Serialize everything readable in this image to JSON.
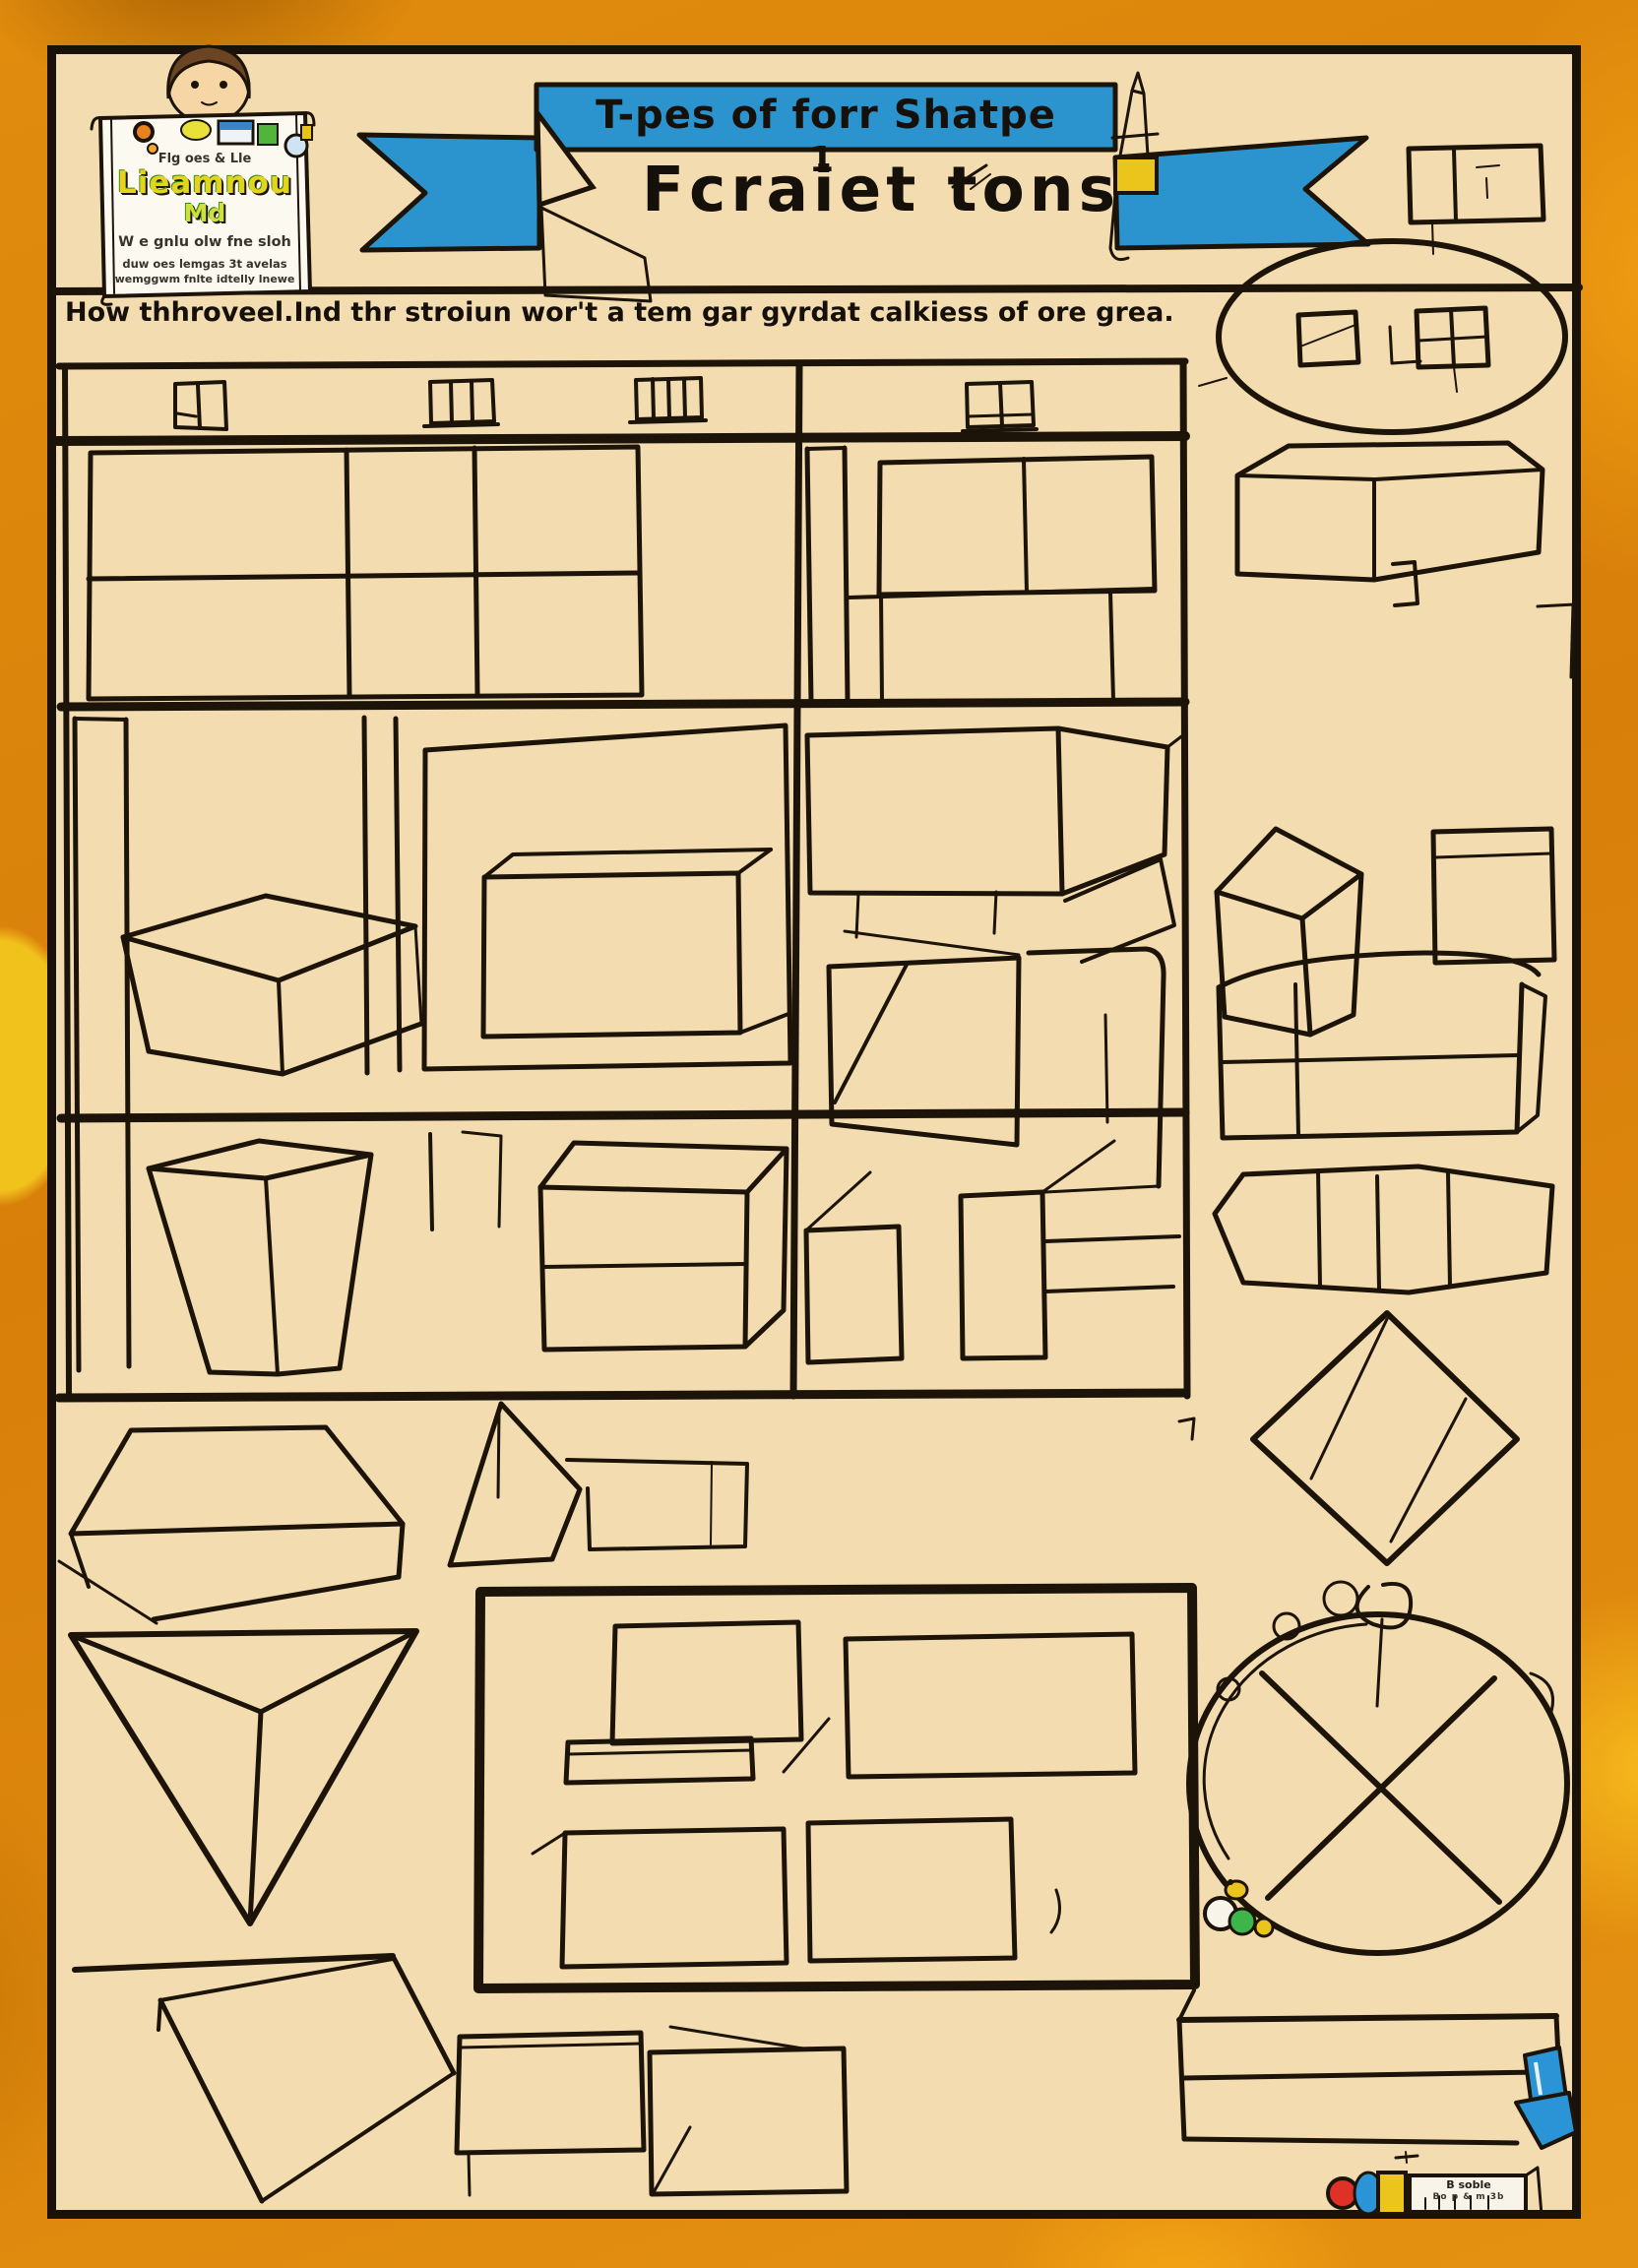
{
  "colors": {
    "border_orange": "#dd860e",
    "page_tan": "#f3ddb0",
    "banner_blue": "#2b94cf",
    "ink": "#1c1309",
    "accent_yellow": "#ecc51c",
    "accent_green": "#3cb54a",
    "accent_red": "#e03127",
    "accent_blue": "#2b94d6"
  },
  "header": {
    "banner_title": "T-pes of forr Shatpe",
    "main_title": "Fcraiet tons",
    "main_title_sup": "1",
    "instruction": "How thhroveel.Ind thr stroiun wor't a tem gar gyrdat calkiess of ore grea."
  },
  "logo": {
    "tagline": "Flg oes & Lle",
    "word_main": "Lieamnou",
    "word_sub": "Md",
    "line1": "W e gnlu olw fne sloh",
    "line2": "duw oes lemgas 3t avelas",
    "line3": "wemggwm fnlte idtelly lnewe"
  },
  "marker_label": {
    "line1": "B soble",
    "line2": "Bo p & m 3b"
  },
  "figures": {
    "table_header_icons": [
      "door-window",
      "three-pane-window",
      "four-pane-window",
      "two-pane-window"
    ],
    "sketches": [
      "partitioned-grid-box",
      "thin-panel",
      "divided-box-with-shelf",
      "open-box-lid",
      "tall-side-panel",
      "panel-with-inset-3d-box",
      "long-3d-table-box",
      "open-box",
      "rounded-panel",
      "bucket-box",
      "cube-dresser",
      "corner-marks",
      "small-panel",
      "stepped-panel",
      "house-prism",
      "triangular-pyramid-with-arm",
      "inverted-triangular-prism",
      "framed-panel-with-four-rectangles",
      "corner-table",
      "square-left",
      "square-right",
      "oval-with-two-squares",
      "wide-prism",
      "cube",
      "plain-square",
      "dresser-3d-box",
      "hexagonal-prism",
      "diamond-kite",
      "wreath-circle-with-cross",
      "beads",
      "long-shelf-with-blue-pencil",
      "marker-with-label",
      "top-right-rectangle",
      "banner-pencil"
    ]
  }
}
